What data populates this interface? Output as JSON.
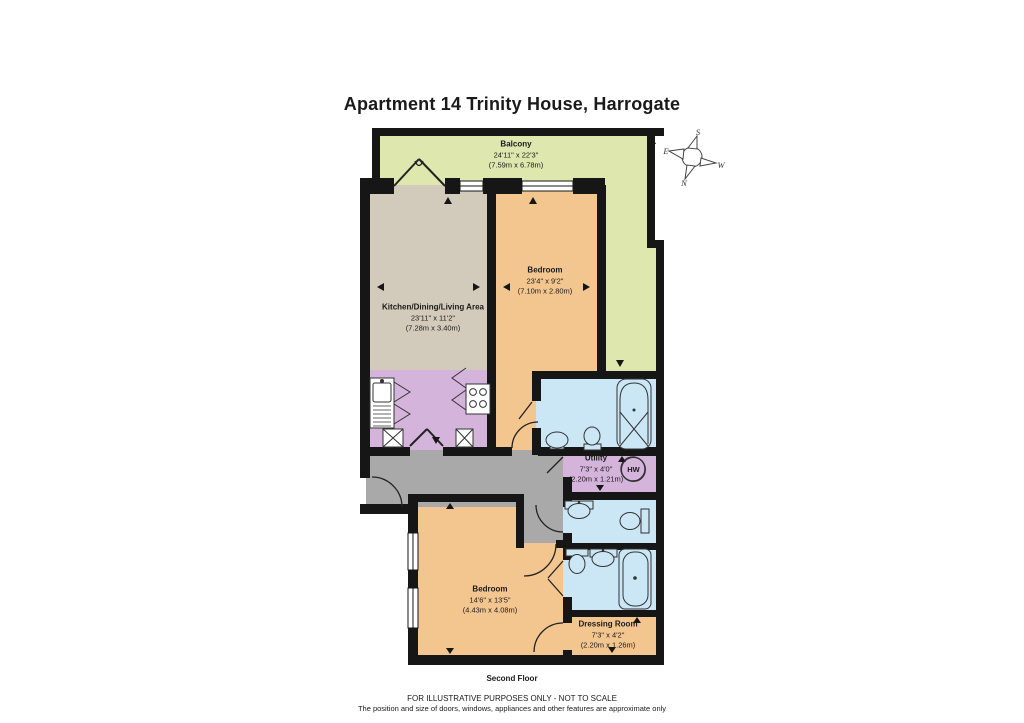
{
  "title": "Apartment 14 Trinity House, Harrogate",
  "floor_label": "Second Floor",
  "disclaimer": {
    "line1": "FOR ILLUSTRATIVE PURPOSES ONLY - NOT TO SCALE",
    "line2": "The position and size of doors, windows, appliances and other features are approximate only"
  },
  "compass": {
    "north": "N",
    "south": "S",
    "east": "E",
    "west": "W"
  },
  "rooms": {
    "balcony": {
      "name": "Balcony",
      "imperial": "24'11\" x 22'3\"",
      "metric": "(7.59m x 6.78m)"
    },
    "kitchen_living": {
      "name": "Kitchen/Dining/Living Area",
      "imperial": "23'11\" x 11'2\"",
      "metric": "(7.28m x 3.40m)"
    },
    "bedroom1": {
      "name": "Bedroom",
      "imperial": "23'4\" x 9'2\"",
      "metric": "(7.10m x 2.80m)"
    },
    "utility": {
      "name": "Utility",
      "imperial": "7'3\" x 4'0\"",
      "metric": "(2.20m x 1.21m)"
    },
    "bedroom2": {
      "name": "Bedroom",
      "imperial": "14'6\" x 13'5\"",
      "metric": "(4.43m x 4.08m)"
    },
    "dressing_room": {
      "name": "Dressing Room",
      "imperial": "7'3\" x 4'2\"",
      "metric": "(2.20m x 1.26m)"
    }
  },
  "labels": {
    "hot_water": "HW"
  },
  "colors": {
    "balcony_green": "#dde7ae",
    "living_tan": "#d2cbbb",
    "bedroom_orange": "#f3c690",
    "kitchen_utility_purple": "#d5b4dc",
    "bathroom_blue": "#cbe6f4",
    "hallway_grey": "#a9a9a9",
    "wall_black": "#161616"
  }
}
